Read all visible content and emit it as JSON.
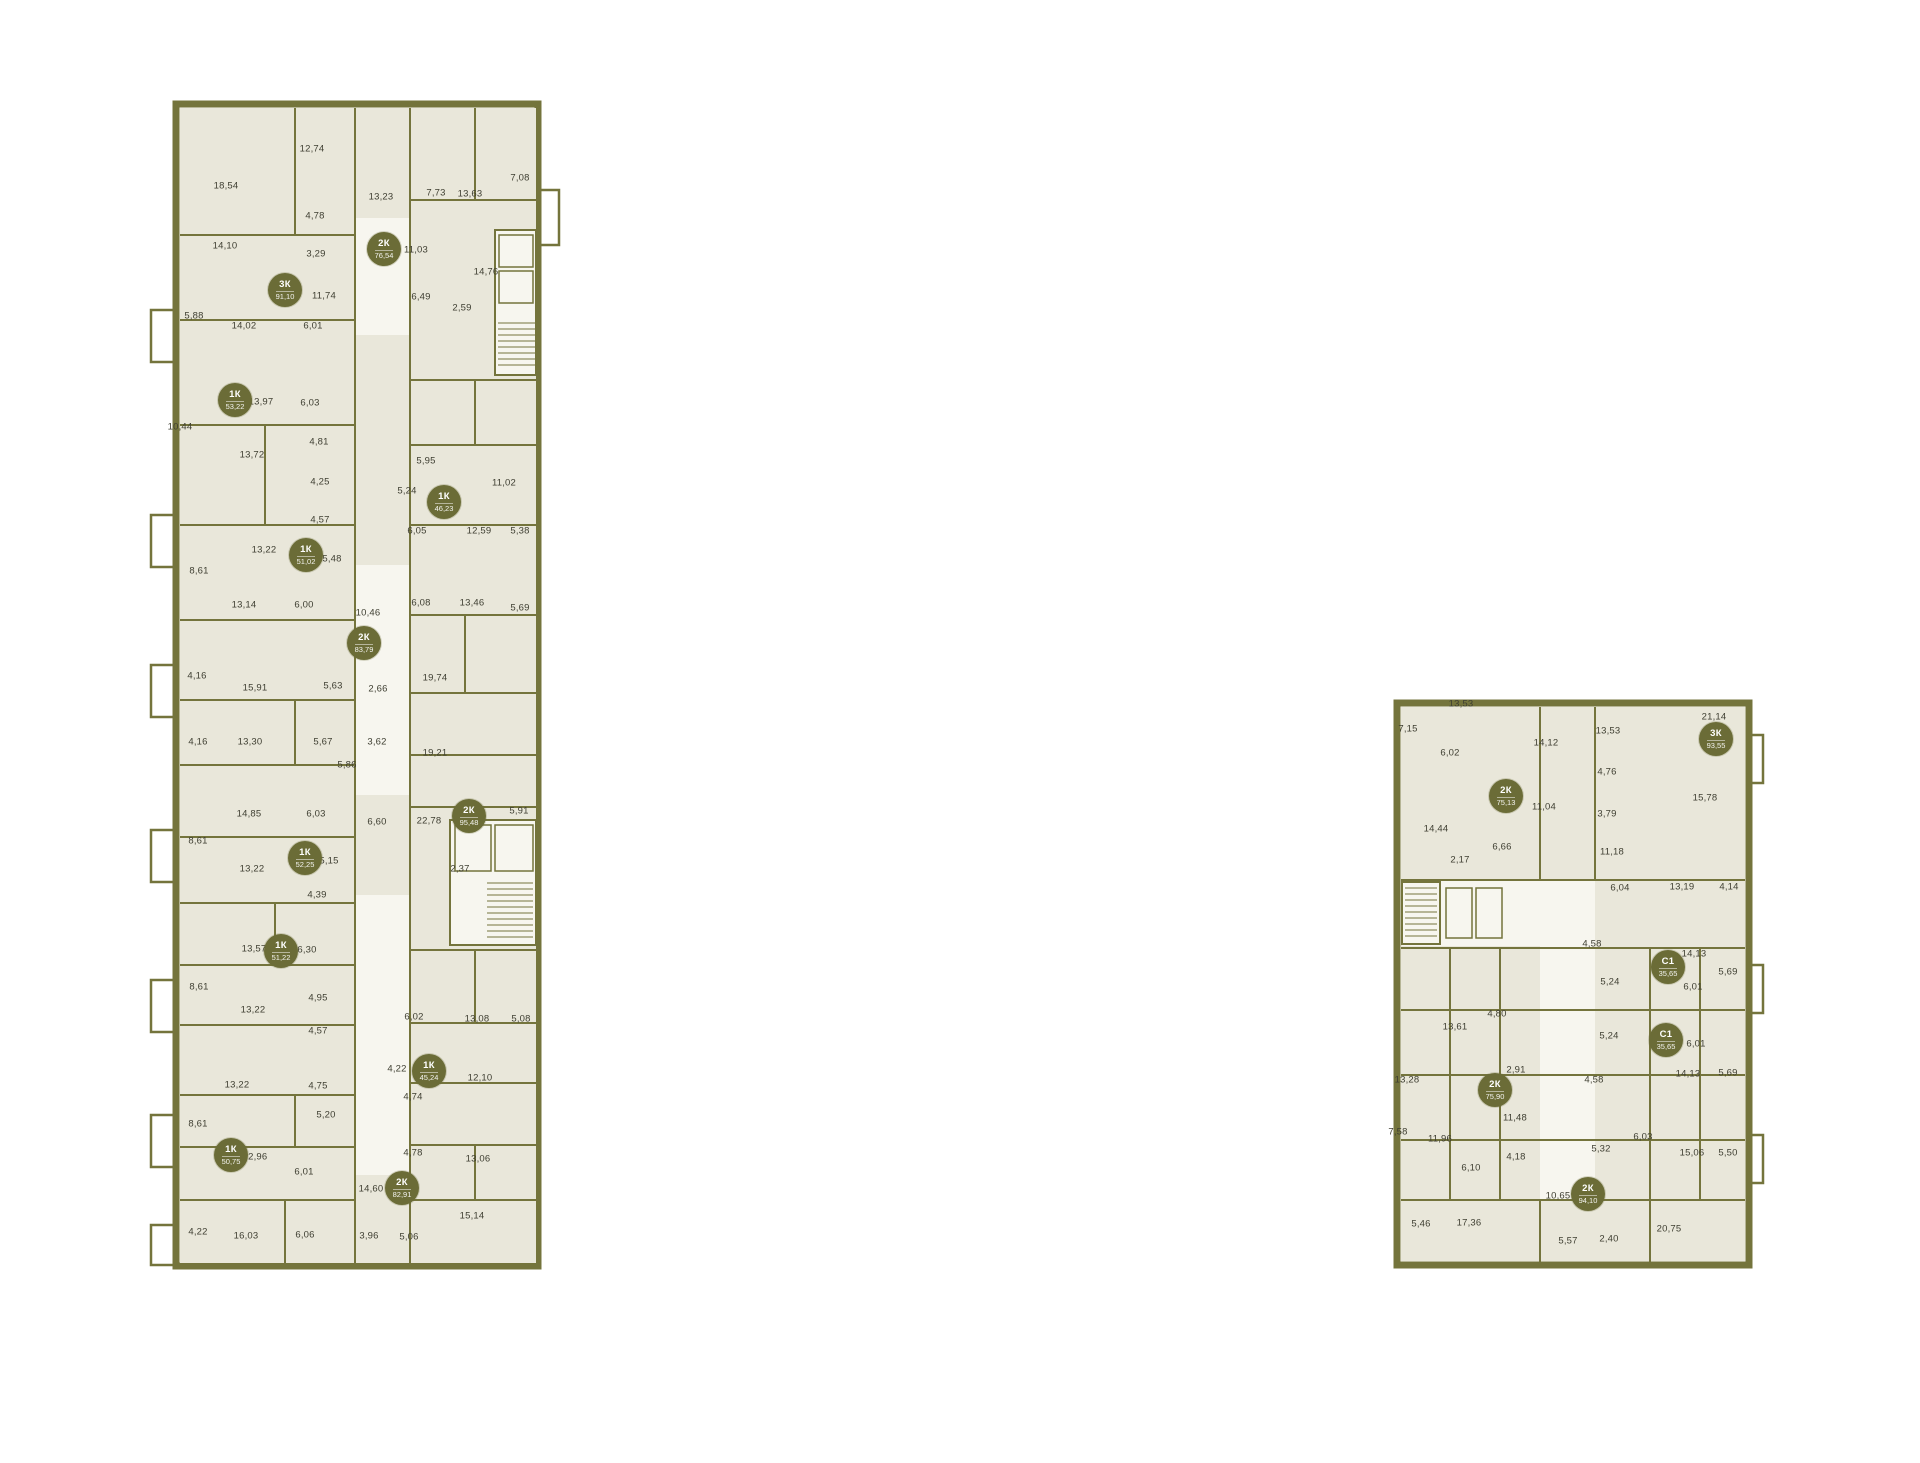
{
  "page": {
    "background": "#ffffff",
    "description": "Residential floor plans with apartment area badges"
  },
  "palette": {
    "wall": "#74743c",
    "room_fill": "#e9e7da",
    "floor_fill": "#f7f6ef",
    "label_color": "#3e3e31",
    "badge_bg": "#6b6c37",
    "badge_text": "#ffffff"
  },
  "buildings": [
    {
      "id": "building-left",
      "x": 145,
      "y": 95,
      "width": 425,
      "height": 1180,
      "apartments": [
        {
          "type": "3К",
          "area": "91,10",
          "x": 140,
          "y": 195
        },
        {
          "type": "2К",
          "area": "76,54",
          "x": 239,
          "y": 154
        },
        {
          "type": "1К",
          "area": "53,22",
          "x": 90,
          "y": 305
        },
        {
          "type": "1К",
          "area": "46,23",
          "x": 299,
          "y": 407
        },
        {
          "type": "1К",
          "area": "51,02",
          "x": 161,
          "y": 460
        },
        {
          "type": "2К",
          "area": "83,79",
          "x": 219,
          "y": 548
        },
        {
          "type": "1К",
          "area": "52,25",
          "x": 160,
          "y": 763
        },
        {
          "type": "2К",
          "area": "95,48",
          "x": 324,
          "y": 721
        },
        {
          "type": "1К",
          "area": "51,22",
          "x": 136,
          "y": 856
        },
        {
          "type": "1К",
          "area": "45,24",
          "x": 284,
          "y": 976
        },
        {
          "type": "1К",
          "area": "50,75",
          "x": 86,
          "y": 1060
        },
        {
          "type": "2К",
          "area": "82,91",
          "x": 257,
          "y": 1093
        }
      ],
      "room_areas": [
        {
          "value": "18,54",
          "x": 81,
          "y": 91
        },
        {
          "value": "12,74",
          "x": 167,
          "y": 54
        },
        {
          "value": "13,23",
          "x": 236,
          "y": 102
        },
        {
          "value": "7,73",
          "x": 291,
          "y": 98
        },
        {
          "value": "13,63",
          "x": 325,
          "y": 99
        },
        {
          "value": "7,08",
          "x": 375,
          "y": 83
        },
        {
          "value": "4,78",
          "x": 170,
          "y": 121
        },
        {
          "value": "3,29",
          "x": 171,
          "y": 159
        },
        {
          "value": "11,03",
          "x": 271,
          "y": 155
        },
        {
          "value": "14,10",
          "x": 80,
          "y": 151
        },
        {
          "value": "11,74",
          "x": 179,
          "y": 201
        },
        {
          "value": "6,49",
          "x": 276,
          "y": 202
        },
        {
          "value": "14,76",
          "x": 341,
          "y": 177
        },
        {
          "value": "2,59",
          "x": 317,
          "y": 213
        },
        {
          "value": "5,88",
          "x": 49,
          "y": 221
        },
        {
          "value": "14,02",
          "x": 99,
          "y": 231
        },
        {
          "value": "6,01",
          "x": 168,
          "y": 231
        },
        {
          "value": "13,97",
          "x": 116,
          "y": 307
        },
        {
          "value": "6,03",
          "x": 165,
          "y": 308
        },
        {
          "value": "10,44",
          "x": 35,
          "y": 332
        },
        {
          "value": "4,81",
          "x": 174,
          "y": 347
        },
        {
          "value": "13,72",
          "x": 107,
          "y": 360
        },
        {
          "value": "5,95",
          "x": 281,
          "y": 366
        },
        {
          "value": "5,24",
          "x": 262,
          "y": 396
        },
        {
          "value": "4,25",
          "x": 175,
          "y": 387
        },
        {
          "value": "11,02",
          "x": 359,
          "y": 388
        },
        {
          "value": "4,57",
          "x": 175,
          "y": 425
        },
        {
          "value": "6,05",
          "x": 272,
          "y": 436
        },
        {
          "value": "13,22",
          "x": 119,
          "y": 455
        },
        {
          "value": "5,48",
          "x": 187,
          "y": 464
        },
        {
          "value": "12,59",
          "x": 334,
          "y": 436
        },
        {
          "value": "5,38",
          "x": 375,
          "y": 436
        },
        {
          "value": "8,61",
          "x": 54,
          "y": 476
        },
        {
          "value": "6,08",
          "x": 276,
          "y": 508
        },
        {
          "value": "13,14",
          "x": 99,
          "y": 510
        },
        {
          "value": "6,00",
          "x": 159,
          "y": 510
        },
        {
          "value": "10,46",
          "x": 223,
          "y": 518
        },
        {
          "value": "13,46",
          "x": 327,
          "y": 508
        },
        {
          "value": "5,69",
          "x": 375,
          "y": 513
        },
        {
          "value": "4,16",
          "x": 52,
          "y": 581
        },
        {
          "value": "15,91",
          "x": 110,
          "y": 593
        },
        {
          "value": "5,63",
          "x": 188,
          "y": 591
        },
        {
          "value": "2,66",
          "x": 233,
          "y": 594
        },
        {
          "value": "19,74",
          "x": 290,
          "y": 583
        },
        {
          "value": "4,16",
          "x": 53,
          "y": 647
        },
        {
          "value": "13,30",
          "x": 105,
          "y": 647
        },
        {
          "value": "5,67",
          "x": 178,
          "y": 647
        },
        {
          "value": "3,62",
          "x": 232,
          "y": 647
        },
        {
          "value": "19,21",
          "x": 290,
          "y": 658
        },
        {
          "value": "5,86",
          "x": 202,
          "y": 670
        },
        {
          "value": "14,85",
          "x": 104,
          "y": 719
        },
        {
          "value": "6,03",
          "x": 171,
          "y": 719
        },
        {
          "value": "6,60",
          "x": 232,
          "y": 727
        },
        {
          "value": "22,78",
          "x": 284,
          "y": 726
        },
        {
          "value": "5,91",
          "x": 374,
          "y": 716
        },
        {
          "value": "8,61",
          "x": 53,
          "y": 746
        },
        {
          "value": "5,15",
          "x": 184,
          "y": 766
        },
        {
          "value": "13,22",
          "x": 107,
          "y": 774
        },
        {
          "value": "2,37",
          "x": 315,
          "y": 774
        },
        {
          "value": "4,39",
          "x": 172,
          "y": 800
        },
        {
          "value": "13,57",
          "x": 109,
          "y": 854
        },
        {
          "value": "6,30",
          "x": 162,
          "y": 855
        },
        {
          "value": "8,61",
          "x": 54,
          "y": 892
        },
        {
          "value": "13,22",
          "x": 108,
          "y": 915
        },
        {
          "value": "4,95",
          "x": 173,
          "y": 903
        },
        {
          "value": "6,02",
          "x": 269,
          "y": 922
        },
        {
          "value": "13,08",
          "x": 332,
          "y": 924
        },
        {
          "value": "5,08",
          "x": 376,
          "y": 924
        },
        {
          "value": "4,57",
          "x": 173,
          "y": 936
        },
        {
          "value": "4,22",
          "x": 252,
          "y": 974
        },
        {
          "value": "12,10",
          "x": 335,
          "y": 983
        },
        {
          "value": "13,22",
          "x": 92,
          "y": 990
        },
        {
          "value": "4,75",
          "x": 173,
          "y": 991
        },
        {
          "value": "4,74",
          "x": 268,
          "y": 1002
        },
        {
          "value": "8,61",
          "x": 53,
          "y": 1029
        },
        {
          "value": "5,20",
          "x": 181,
          "y": 1020
        },
        {
          "value": "4,78",
          "x": 268,
          "y": 1058
        },
        {
          "value": "12,96",
          "x": 110,
          "y": 1062
        },
        {
          "value": "13,06",
          "x": 333,
          "y": 1064
        },
        {
          "value": "6,01",
          "x": 159,
          "y": 1077
        },
        {
          "value": "14,60",
          "x": 226,
          "y": 1094
        },
        {
          "value": "15,14",
          "x": 327,
          "y": 1121
        },
        {
          "value": "4,22",
          "x": 53,
          "y": 1137
        },
        {
          "value": "16,03",
          "x": 101,
          "y": 1141
        },
        {
          "value": "6,06",
          "x": 160,
          "y": 1140
        },
        {
          "value": "3,96",
          "x": 224,
          "y": 1141
        },
        {
          "value": "5,06",
          "x": 264,
          "y": 1142
        }
      ]
    },
    {
      "id": "building-right",
      "x": 1390,
      "y": 680,
      "width": 375,
      "height": 600,
      "apartments": [
        {
          "type": "2К",
          "area": "75,13",
          "x": 116,
          "y": 116
        },
        {
          "type": "3К",
          "area": "93,55",
          "x": 326,
          "y": 59
        },
        {
          "type": "С1",
          "area": "35,65",
          "x": 278,
          "y": 287
        },
        {
          "type": "С1",
          "area": "35,65",
          "x": 276,
          "y": 360
        },
        {
          "type": "2К",
          "area": "75,90",
          "x": 105,
          "y": 410
        },
        {
          "type": "2К",
          "area": "94,10",
          "x": 198,
          "y": 514
        }
      ],
      "room_areas": [
        {
          "value": "13,53",
          "x": 71,
          "y": 24
        },
        {
          "value": "7,15",
          "x": 18,
          "y": 49
        },
        {
          "value": "14,12",
          "x": 156,
          "y": 63
        },
        {
          "value": "13,53",
          "x": 218,
          "y": 51
        },
        {
          "value": "21,14",
          "x": 324,
          "y": 37
        },
        {
          "value": "6,02",
          "x": 60,
          "y": 73
        },
        {
          "value": "4,76",
          "x": 217,
          "y": 92
        },
        {
          "value": "11,04",
          "x": 154,
          "y": 127
        },
        {
          "value": "3,79",
          "x": 217,
          "y": 134
        },
        {
          "value": "15,78",
          "x": 315,
          "y": 118
        },
        {
          "value": "14,44",
          "x": 46,
          "y": 149
        },
        {
          "value": "6,66",
          "x": 112,
          "y": 167
        },
        {
          "value": "2,17",
          "x": 70,
          "y": 180
        },
        {
          "value": "11,18",
          "x": 222,
          "y": 172
        },
        {
          "value": "6,04",
          "x": 230,
          "y": 208
        },
        {
          "value": "13,19",
          "x": 292,
          "y": 207
        },
        {
          "value": "4,14",
          "x": 339,
          "y": 207
        },
        {
          "value": "4,58",
          "x": 202,
          "y": 264
        },
        {
          "value": "14,13",
          "x": 304,
          "y": 274
        },
        {
          "value": "5,69",
          "x": 338,
          "y": 292
        },
        {
          "value": "5,24",
          "x": 220,
          "y": 302
        },
        {
          "value": "6,01",
          "x": 303,
          "y": 307
        },
        {
          "value": "4,80",
          "x": 107,
          "y": 334
        },
        {
          "value": "13,61",
          "x": 65,
          "y": 347
        },
        {
          "value": "5,24",
          "x": 219,
          "y": 356
        },
        {
          "value": "6,01",
          "x": 306,
          "y": 364
        },
        {
          "value": "2,91",
          "x": 126,
          "y": 390
        },
        {
          "value": "13,28",
          "x": 17,
          "y": 400
        },
        {
          "value": "4,58",
          "x": 204,
          "y": 400
        },
        {
          "value": "14,13",
          "x": 298,
          "y": 394
        },
        {
          "value": "5,69",
          "x": 338,
          "y": 393
        },
        {
          "value": "11,48",
          "x": 125,
          "y": 438
        },
        {
          "value": "7,58",
          "x": 8,
          "y": 452
        },
        {
          "value": "11,96",
          "x": 50,
          "y": 459
        },
        {
          "value": "6,10",
          "x": 81,
          "y": 488
        },
        {
          "value": "4,18",
          "x": 126,
          "y": 477
        },
        {
          "value": "5,32",
          "x": 211,
          "y": 469
        },
        {
          "value": "6,03",
          "x": 253,
          "y": 457
        },
        {
          "value": "15,06",
          "x": 302,
          "y": 473
        },
        {
          "value": "5,50",
          "x": 338,
          "y": 473
        },
        {
          "value": "10,65",
          "x": 168,
          "y": 516
        },
        {
          "value": "5,46",
          "x": 31,
          "y": 544
        },
        {
          "value": "17,36",
          "x": 79,
          "y": 543
        },
        {
          "value": "5,57",
          "x": 178,
          "y": 561
        },
        {
          "value": "2,40",
          "x": 219,
          "y": 559
        },
        {
          "value": "20,75",
          "x": 279,
          "y": 549
        }
      ]
    }
  ]
}
